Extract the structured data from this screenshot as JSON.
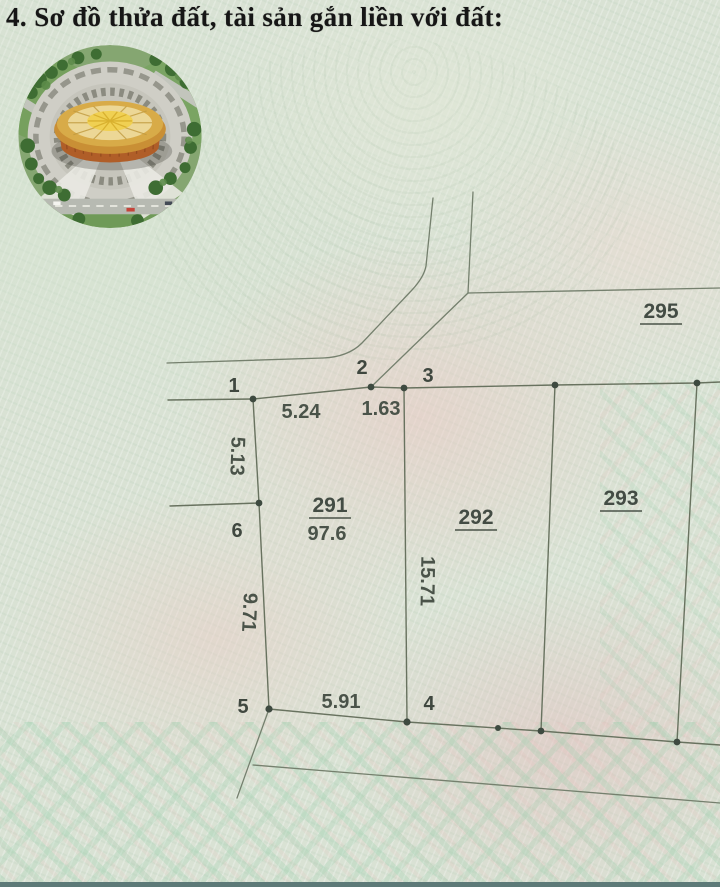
{
  "page": {
    "title": "4. Sơ đồ thửa đất, tài sản gắn liền với đất:"
  },
  "photo": {
    "name": "aerial-view-golden-drum-building",
    "description_visible": ""
  },
  "diagram": {
    "parcels": {
      "p291": {
        "id": "291",
        "area": "97.6"
      },
      "p292": {
        "id": "292"
      },
      "p293": {
        "id": "293"
      },
      "p295": {
        "id": "295"
      }
    },
    "points": {
      "p1": "1",
      "p2": "2",
      "p3": "3",
      "p4": "4",
      "p5": "5",
      "p6": "6"
    },
    "dimensions": {
      "edge_1_2": "5.24",
      "edge_2_3": "1.63",
      "edge_1_6": "5.13",
      "edge_6_5": "9.71",
      "edge_3_4": "15.71",
      "edge_5_4": "5.91"
    }
  },
  "colors": {
    "paper_green": "#d9e2d4",
    "paper_pink": "#ecd3cc",
    "boundary_line": "#68725f",
    "diagram_text": "#4a5349",
    "title_text": "#161616",
    "photo_gold": "#e2bc5e",
    "photo_bronze": "#b05e28"
  }
}
